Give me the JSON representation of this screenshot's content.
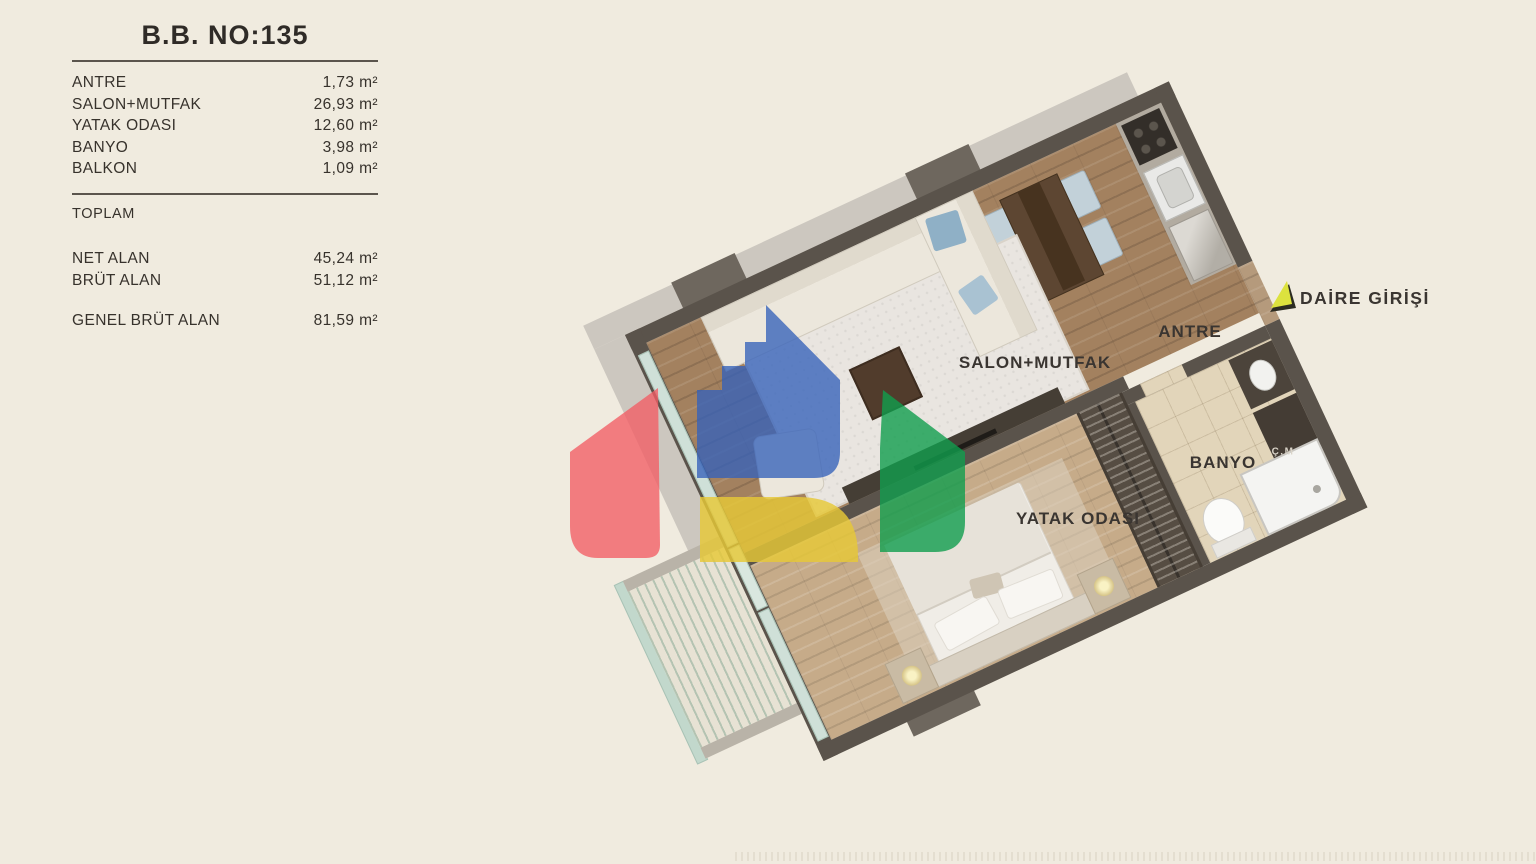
{
  "info_panel": {
    "title": "B.B. NO:135",
    "rooms": [
      {
        "label": "ANTRE",
        "value": "1,73 m²"
      },
      {
        "label": "SALON+MUTFAK",
        "value": "26,93 m²"
      },
      {
        "label": "YATAK ODASI",
        "value": "12,60 m²"
      },
      {
        "label": "BANYO",
        "value": "3,98 m²"
      },
      {
        "label": "BALKON",
        "value": "1,09 m²"
      }
    ],
    "section_label": "TOPLAM",
    "totals": [
      {
        "label": "NET ALAN",
        "value": "45,24 m²"
      },
      {
        "label": "BRÜT ALAN",
        "value": "51,12 m²"
      }
    ],
    "grand_total": {
      "label": "GENEL BRÜT ALAN",
      "value": "81,59 m²"
    }
  },
  "floor_plan": {
    "unit_number": "135",
    "labels": {
      "salon": "SALON+MUTFAK",
      "antre": "ANTRE",
      "banyo": "BANYO",
      "yatak": "YATAK ODASI",
      "camasir": "Ç.M",
      "entrance": "DAİRE GİRİŞİ"
    },
    "colors": {
      "background": "#f0ebdf",
      "wall": "#5a534b",
      "wood_floor": "#a3815f",
      "bedroom_wood": "#c6ab89",
      "bath_tile": "#e2d5ba",
      "logo_blue": "#3462ba",
      "logo_red": "#f25c64",
      "logo_green": "#109e4e",
      "logo_yellow": "#e6c837",
      "arrow_green": "#dce23e"
    }
  }
}
